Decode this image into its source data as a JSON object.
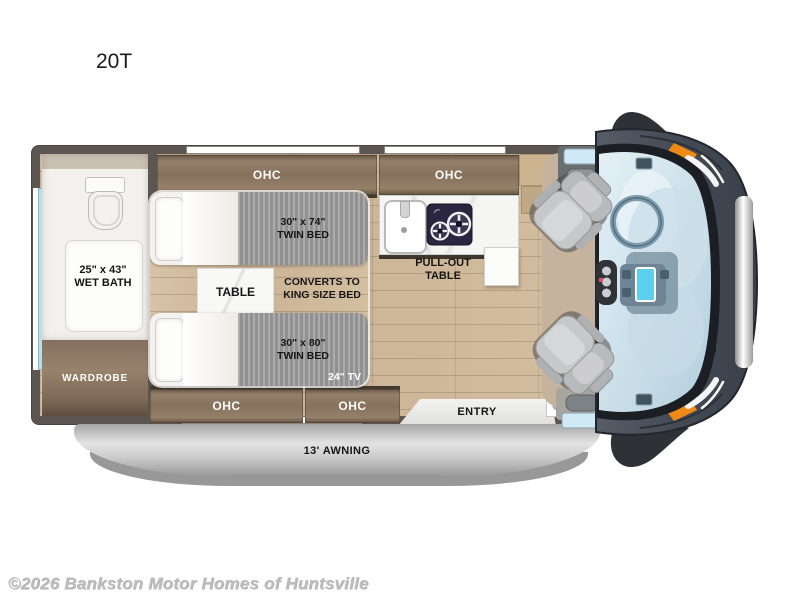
{
  "title": "20T",
  "watermark": "©2026 Bankston Motor Homes of Huntsville",
  "colors": {
    "wall": "#5b5651",
    "cabinet_wood": "#8a755f",
    "floor_wood": "#cfb99d",
    "accent_orange": "#ef8a15",
    "window_blue": "#cfe9f5",
    "awning_gray": "#c6c6c6",
    "cooktop_navy": "#2b2640",
    "blanket_gray": "#9c9c9c"
  },
  "floorplan": {
    "ohc_labels": [
      "OHC",
      "OHC",
      "OHC",
      "OHC"
    ],
    "wet_bath": {
      "line1": "25\" x 43\"",
      "line2": "WET BATH"
    },
    "wardrobe_label": "WARDROBE",
    "bed_top": {
      "line1": "30\" x 74\"",
      "line2": "TWIN BED"
    },
    "bed_bottom": {
      "line1": "30\" x 80\"",
      "line2": "TWIN BED"
    },
    "table_label": "TABLE",
    "converts": {
      "line1": "CONVERTS TO",
      "line2": "KING SIZE BED"
    },
    "tv_label": "24\" TV",
    "pullout": {
      "line1": "PULL-OUT",
      "line2": "TABLE"
    },
    "entry_label": "ENTRY",
    "awning_label": "13' AWNING"
  }
}
